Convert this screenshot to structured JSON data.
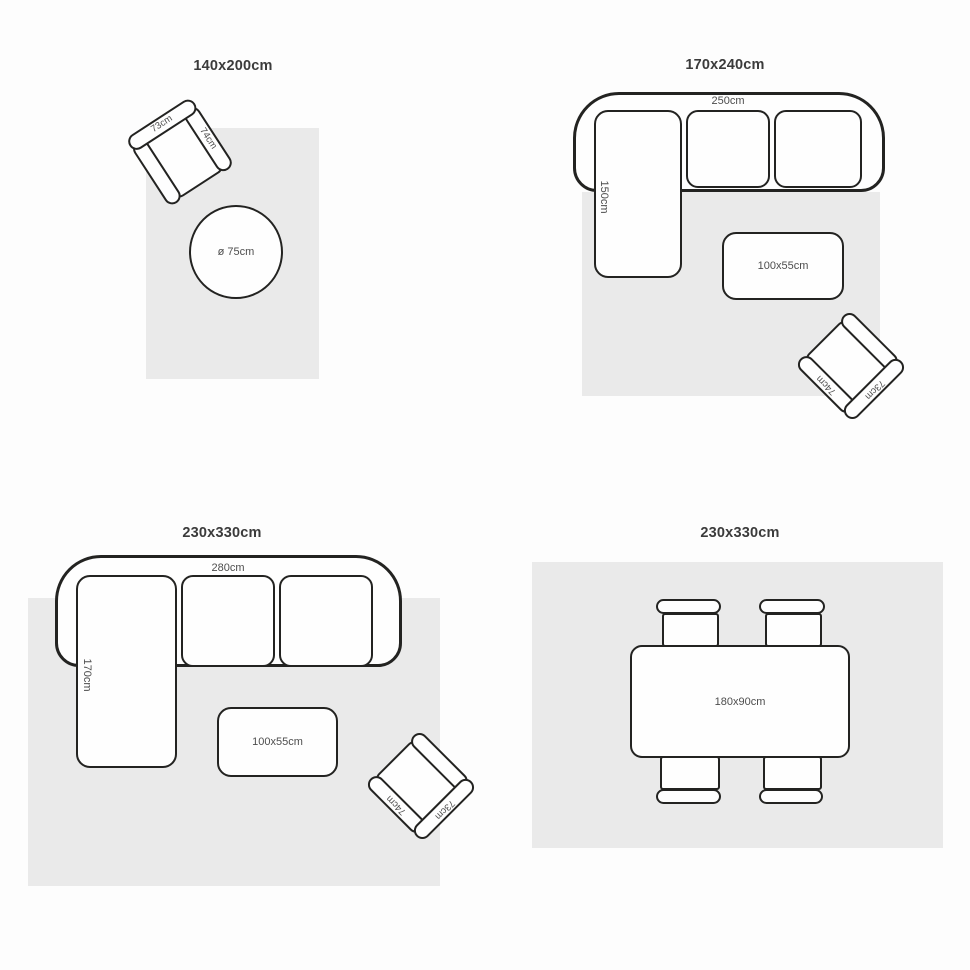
{
  "diagram": "rug-size-guide",
  "colors": {
    "background": "#fdfdfd",
    "rug_fill": "#eaeaea",
    "outline": "#232321",
    "furniture_fill": "#fefefe",
    "title_text": "#3b3b3b",
    "label_text": "#4d4d4d"
  },
  "panels": [
    {
      "title": "140x200cm",
      "armchair": {
        "back_label": "73cm",
        "arm_label": "74cm"
      },
      "round_table": {
        "label": "ø 75cm"
      }
    },
    {
      "title": "170x240cm",
      "sofa": {
        "width_label": "250cm",
        "depth_label": "150cm"
      },
      "coffee_table": {
        "label": "100x55cm"
      },
      "armchair": {
        "back_label": "73cm",
        "arm_label": "74cm"
      }
    },
    {
      "title": "230x330cm",
      "sofa": {
        "width_label": "280cm",
        "depth_label": "170cm"
      },
      "coffee_table": {
        "label": "100x55cm"
      },
      "armchair": {
        "back_label": "73cm",
        "arm_label": "74cm"
      }
    },
    {
      "title": "230x330cm",
      "dining_table": {
        "label": "180x90cm"
      }
    }
  ]
}
